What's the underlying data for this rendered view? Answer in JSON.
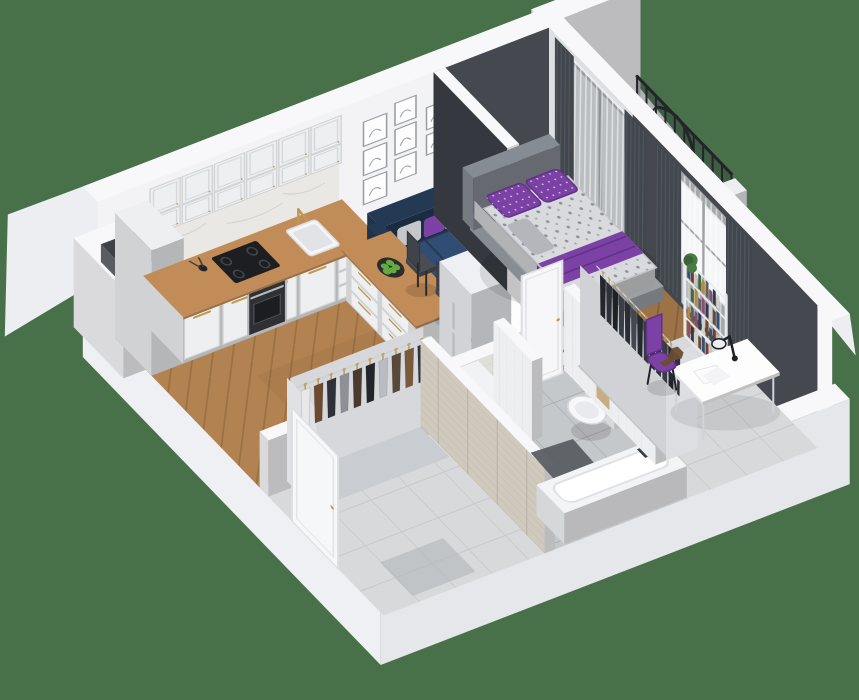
{
  "scene": {
    "label": "3D isometric cutaway floor plan of a studio apartment with kitchen-living room, balcony, bedroom, bathroom and hallway",
    "background": "#487149",
    "rooms": [
      {
        "name": "kitchen-living-room",
        "floor": "oak-herringbone",
        "items": [
          "white-panel-cabinets",
          "marble-backsplash",
          "oven",
          "cooktop",
          "sink",
          "gold-faucet",
          "kitchen-peninsula",
          "bar-stools",
          "fruit-bowl",
          "fridge",
          "navy-sofa",
          "round-coffee-table",
          "diamond-pattern-rug",
          "gallery-wall",
          "balcony-door-curtains"
        ]
      },
      {
        "name": "balcony",
        "floor": "wood-planks",
        "items": [
          "black-railing",
          "hanging-egg-chair",
          "plant"
        ]
      },
      {
        "name": "bedroom",
        "floor": "wood-and-tile",
        "items": [
          "gray-bed",
          "patterned-duvet",
          "purple-pillows",
          "purple-throw",
          "open-wardrobe-dark-clothes",
          "bookshelf",
          "white-desk",
          "desk-lamp",
          "purple-chair",
          "dinosaur-toy",
          "window-curtains",
          "dark-accent-walls"
        ]
      },
      {
        "name": "bathroom",
        "floor": "gray-tile",
        "items": [
          "washing-machine",
          "wall-hung-toilet",
          "bathtub",
          "bath-mat",
          "mosaic-tile-wall",
          "gold-fixtures",
          "bath-door"
        ]
      },
      {
        "name": "hallway",
        "floor": "light-tile",
        "items": [
          "open-wardrobe-mixed-clothes",
          "stone-tile-wall",
          "entrance-door",
          "vent-shaft"
        ]
      }
    ],
    "counts": {
      "gallery_frames": 8,
      "hall_garments": 10,
      "bedroom_garments": 13,
      "balcony_rail_posts": 10,
      "apples": 5
    }
  },
  "colors": {
    "background": "#487149",
    "wall_top": "#f8f8fa",
    "wall_inner": "#f3f3f5",
    "wall_shell": "#edeef2",
    "wall_outer_sw": "#eff0f3",
    "wall_outer_se": "#e6e7eb",
    "wall_dark": "#45494f",
    "wall_dark_deep": "#35383e",
    "part_end": "#cfd1d5",
    "floor_wood": "#b28351",
    "floor_wood_line": "#9a6f41",
    "floor_wood_dark": "#9c7246",
    "floor_wood_dark_line": "#845f38",
    "balcony_wood": "#a08562",
    "balcony_wood_line": "#8b7050",
    "tile_hall": "#d8d9db",
    "tile_hall_line": "#c6c7ca",
    "tile_bath": "#c5c8cb",
    "tile_bath_line": "#abaeb2",
    "bath_wall_tile": "#dedfda",
    "bath_wall_tile_line": "#cdcec7",
    "brick": "#cfc9be",
    "brick_line": "#b7b1a4",
    "mosaic": "#eff0f2",
    "mosaic_line": "#d8dbde",
    "rug_base": "#ededee",
    "rug_line": "#3a3d43",
    "mat": "#5c6064",
    "cabinet": "#edeff1",
    "counter_wood": "#c18c57",
    "marble": "#eae8e5",
    "marble_vein": "#d5d2cd",
    "steel": "#b6b9bd",
    "dark": "#26282c",
    "gold": "#c09850",
    "white": "#fdfdfe",
    "sofa": "#2d4567",
    "sofa_dark": "#243a54",
    "pillow_gray": "#c6c7cb",
    "pillow_gray2": "#b4b6bc",
    "purple": "#7b41a5",
    "purple_dark": "#613189",
    "duvet": "#d9dadd",
    "bed_frame": "#9ba0a6",
    "headboard": "#868c93",
    "curtain": "#42464d",
    "curtain_fold": "#555a62",
    "sheer": "#f4f5f7",
    "door_dark": "#3a3d42",
    "glass": "#b9c2c8",
    "washer": "#f1f2f4",
    "washer_ring": "#2b2d31",
    "washer_glass": "#656a70",
    "toilet": "#f7f8fa",
    "tub": "#f3f4f6",
    "plant": "#4a7a43",
    "plant_dark": "#3c6337",
    "apple": "#63ab3f",
    "shelf": "#f5f6f8",
    "toy": "#6b4d32",
    "hall_clothes": [
      "#e8e8ea",
      "#6b4a2f",
      "#2e3137",
      "#8d9097",
      "#4a3b2c",
      "#22252a",
      "#b9bcc2",
      "#59493a",
      "#7a5a3a",
      "#31353b"
    ],
    "bedroom_clothes": [
      "#23262c",
      "#2e3138",
      "#1e2125",
      "#3a3e46",
      "#2a2d34",
      "#43474f",
      "#26292f",
      "#33363d",
      "#1f2227",
      "#2c2f36",
      "#383c43",
      "#24272d",
      "#2f323a"
    ],
    "book_colors": [
      "#31507a",
      "#7a3b2f",
      "#c9c4ba",
      "#3a6b4f",
      "#b58a3c",
      "#5d6066",
      "#8a4f6d",
      "#2f3a55",
      "#d2cfc8",
      "#6b4a2f"
    ]
  }
}
